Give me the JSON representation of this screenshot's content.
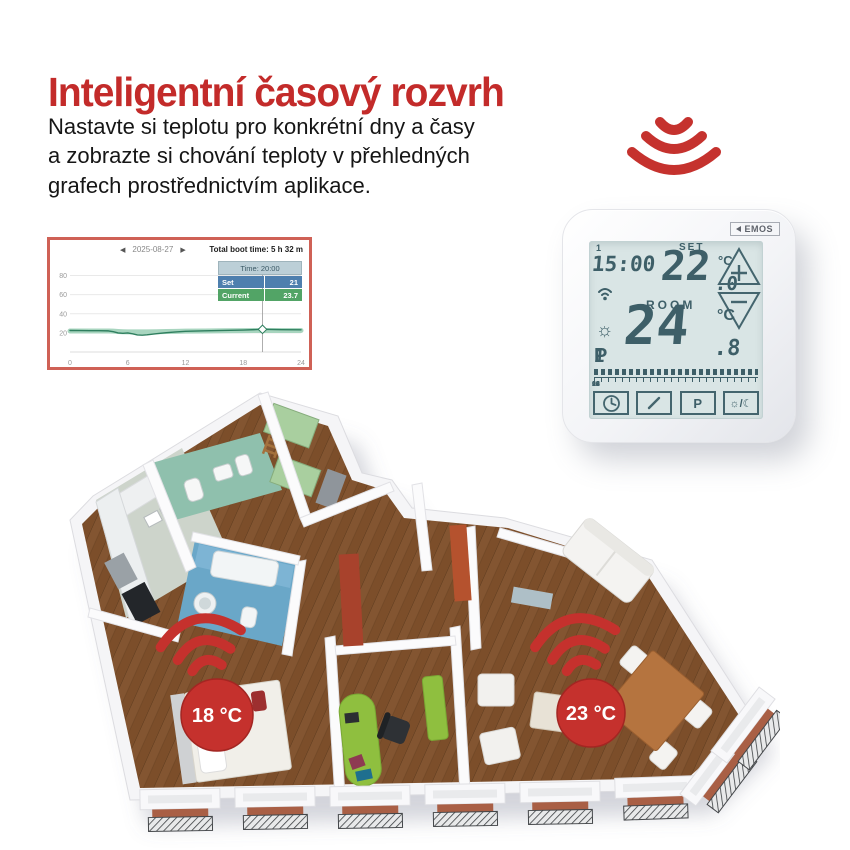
{
  "header": {
    "title": "Inteligentní časový rozvrh",
    "title_color": "#c32b2a",
    "body_line1": "Nastavte si teplotu pro konkrétní dny a časy",
    "body_line2": "a zobrazte si chování teploty v přehledných",
    "body_line3": "grafech prostřednictvím aplikace."
  },
  "app_chart": {
    "prev_icon": "◀",
    "next_icon": "▶",
    "date": "2025-08-27",
    "boot_time": "Total boot time: 5 h 32 m",
    "tooltip": {
      "time_label": "Time: 20:00",
      "rows": [
        {
          "label": "Set",
          "value": "21",
          "color": "#4e7fae"
        },
        {
          "label": "Current",
          "value": "23.7",
          "color": "#52a466"
        }
      ]
    },
    "chart_data": {
      "type": "line",
      "title": "",
      "xlabel": "hour of day",
      "ylabel": "temperature °C",
      "xlim": [
        0,
        24
      ],
      "ylim": [
        0,
        90
      ],
      "yticks": [
        20,
        40,
        60,
        80
      ],
      "xticks": [
        0,
        6,
        12,
        18,
        24
      ],
      "grid": true,
      "legend": "none",
      "x": [
        0,
        1,
        2,
        3,
        4,
        4.5,
        5,
        5.5,
        6,
        6.5,
        7,
        7.5,
        8,
        9,
        10,
        11,
        12,
        14,
        16,
        18,
        20,
        22,
        24
      ],
      "series": [
        {
          "name": "Set",
          "color": "#a8d5bf",
          "width": 5,
          "values": [
            22,
            22,
            22,
            22,
            22,
            21.8,
            21.5,
            21.2,
            21,
            21,
            21,
            21,
            21,
            21.2,
            21.4,
            21.6,
            21.8,
            22,
            22.2,
            22.4,
            22.5,
            22.5,
            22.5
          ]
        },
        {
          "name": "Current",
          "color": "#2f7f5f",
          "width": 1.4,
          "values": [
            22.5,
            22.4,
            22.3,
            22.3,
            22.1,
            21.2,
            20,
            19.6,
            19.9,
            19,
            17.9,
            17.6,
            18,
            19.2,
            20.2,
            21,
            21.7,
            22.2,
            22.6,
            23,
            23.7,
            23.3,
            23.2
          ]
        }
      ],
      "cursor_x": 20,
      "cursor_value": 23.7
    }
  },
  "thermostat": {
    "brand": "EMOS",
    "day_indicator": "1",
    "time": "15:00",
    "set_label": "SET",
    "set_temp_int": "22",
    "set_temp_dec": ".0",
    "set_deg": "°C",
    "plus_label": "+",
    "minus_label": "−",
    "room_label": "ROOM",
    "room_temp_int": "24",
    "room_temp_dec": ".8",
    "room_deg": "°C",
    "sun_indicator": "☼",
    "program_prefix": "P",
    "program_number": "1",
    "timeline_labels": [
      "00",
      "06",
      "12",
      "18",
      "24"
    ],
    "program_button_label": "P",
    "day_night_label": "☼/☾"
  },
  "floorplan": {
    "accent": "#c5312d",
    "badges": [
      {
        "label": "18 °C"
      },
      {
        "label": "23 °C"
      }
    ]
  }
}
